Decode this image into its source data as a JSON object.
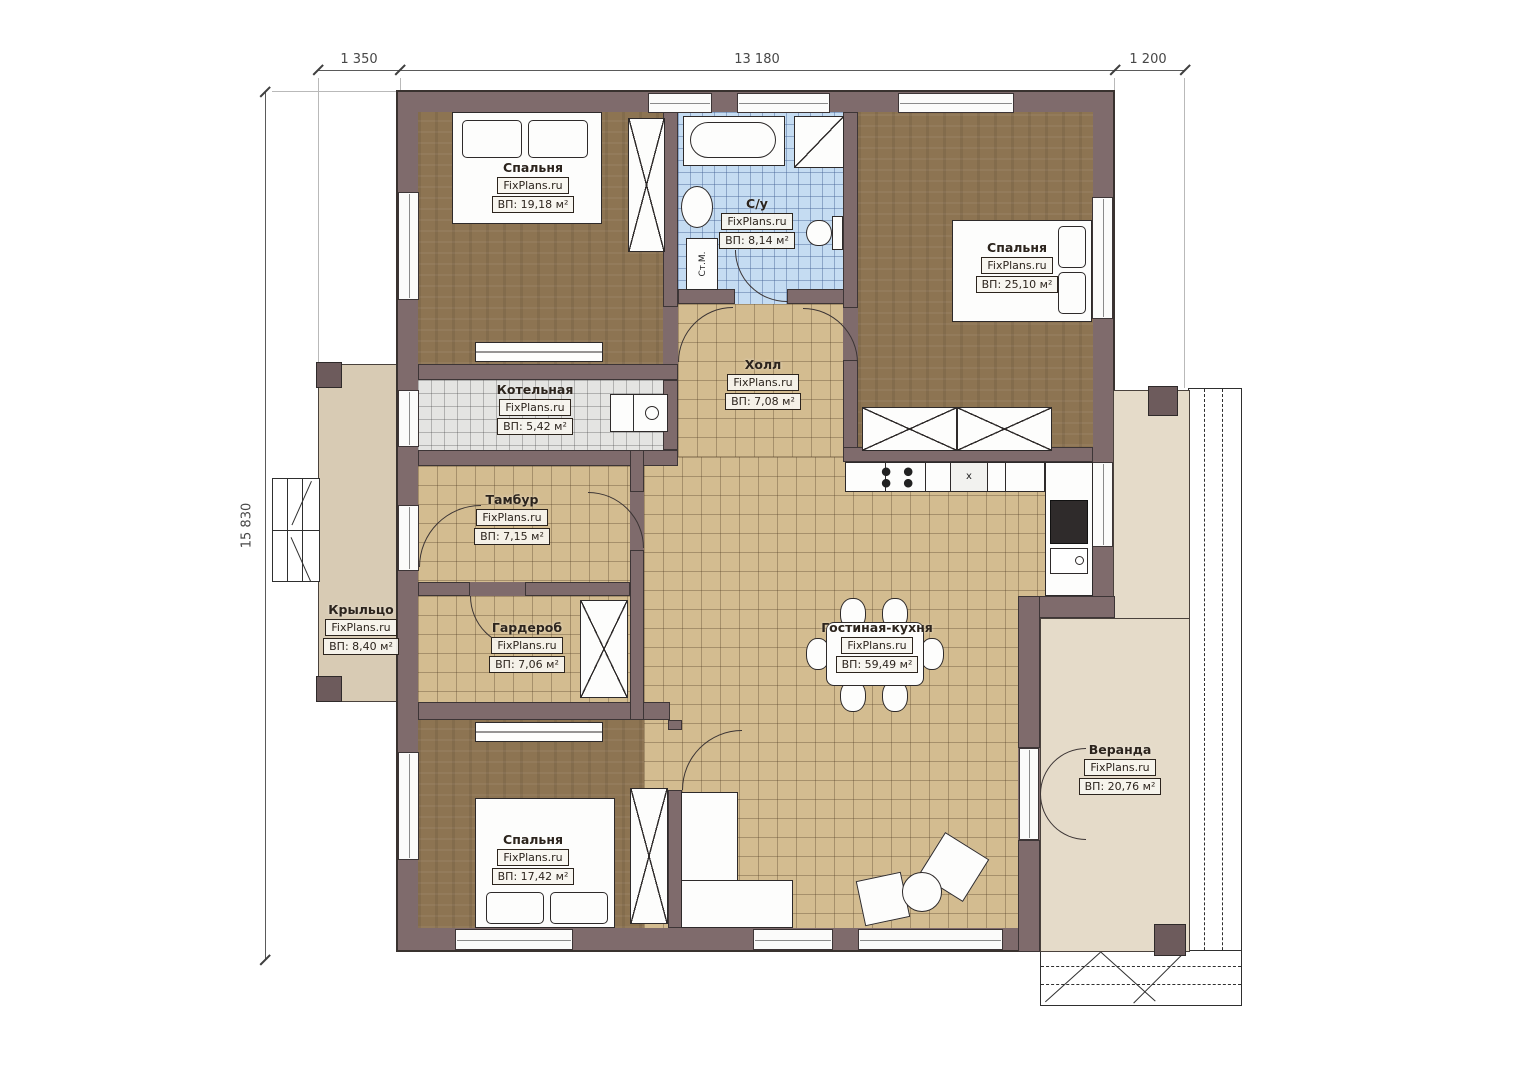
{
  "brand": "FixPlans.ru",
  "dimensions": {
    "top_left": "1 350",
    "top_middle": "13 180",
    "top_right": "1 200",
    "left": "15 830"
  },
  "rooms": [
    {
      "name": "Спальня",
      "area": "ВП: 19,18 м²"
    },
    {
      "name": "С/у",
      "area": "ВП: 8,14 м²"
    },
    {
      "name": "Спальня",
      "area": "ВП: 25,10 м²"
    },
    {
      "name": "Котельная",
      "area": "ВП: 5,42 м²"
    },
    {
      "name": "Холл",
      "area": "ВП: 7,08 м²"
    },
    {
      "name": "Тамбур",
      "area": "ВП: 7,15 м²"
    },
    {
      "name": "Гардероб",
      "area": "ВП: 7,06 м²"
    },
    {
      "name": "Крыльцо",
      "area": "ВП: 8,40 м²"
    },
    {
      "name": "Спальня",
      "area": "ВП: 17,42 м²"
    },
    {
      "name": "Гостиная-кухня",
      "area": "ВП: 59,49 м²"
    },
    {
      "name": "Веранда",
      "area": "ВП: 20,76 м²"
    }
  ],
  "annotations": {
    "washing_machine": "Ст.М.",
    "sink_mark": "x"
  },
  "colors": {
    "wall": "#7f6b6c",
    "tile_beige": "#d3bc90",
    "tile_bath": "#c5dcf2",
    "tile_gray": "#e4e4e2",
    "floor_wood": "#8d7452",
    "porch": "#d8cbb4",
    "veranda": "#e5dbc9"
  }
}
